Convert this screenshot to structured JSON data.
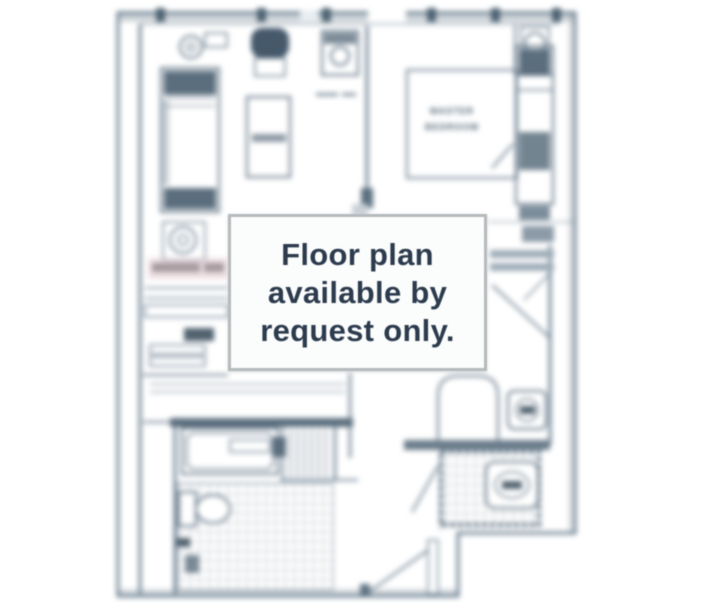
{
  "page": {
    "background_color": "#ffffff",
    "description": "Blurred apartment floor plan with availability notice overlay"
  },
  "notice": {
    "line1": "Floor plan",
    "line2": "available by",
    "line3": "request only.",
    "text_color": "#2c3b4d",
    "background": "#fbfcfc",
    "border_color": "#b5babc"
  },
  "floor_plan": {
    "room_labels": {
      "master_line1": "MASTER",
      "master_line2": "BEDROOM"
    },
    "line_color": "#6b7f90",
    "furniture_stroke": "#5d7182",
    "dark_fill": "#4e6171",
    "wall_band_color": "#a9b4bc",
    "watermark_band_color": "#e3ccd0",
    "watermark_text_color": "#94888d",
    "blur_px": 2.6
  }
}
